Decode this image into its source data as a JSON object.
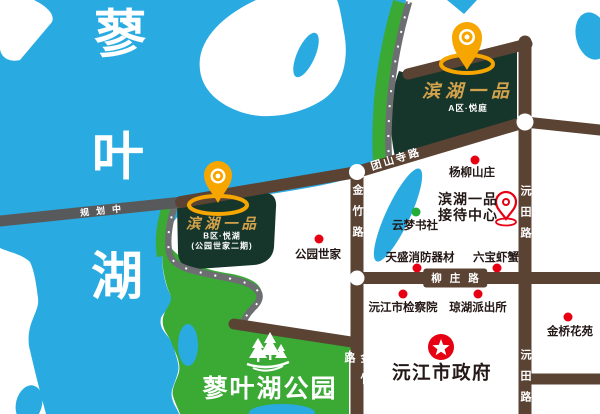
{
  "lake": {
    "char1": "蓼",
    "char2": "叶",
    "char3": "湖",
    "full_name": "蓼叶湖"
  },
  "park": {
    "name": "蓼叶湖公园"
  },
  "estate_a": {
    "title": "滨湖一品",
    "subtitle": "A区·悦庭"
  },
  "estate_b": {
    "title": "滨湖一品",
    "subtitle": "B区·悦湖",
    "note": "(公园世家二期)"
  },
  "reception": {
    "line1": "滨湖一品",
    "line2": "接待中心"
  },
  "government": {
    "name": "沅江市政府"
  },
  "roads": {
    "planned": "规划中",
    "tuanshan": "团山寺路",
    "liuzhuang": "柳庄路",
    "jinzhu": "金竹路",
    "yuantian": "沅田路"
  },
  "pois": [
    {
      "name": "杨柳山庄",
      "marker": "red-dot"
    },
    {
      "name": "云梦书社",
      "marker": "green-dot"
    },
    {
      "name": "公园世家",
      "marker": "red-dot"
    },
    {
      "name": "天盛消防器材",
      "marker": "red-dot"
    },
    {
      "name": "六宝虾蟹",
      "marker": "red-dot"
    },
    {
      "name": "沅江市检察院",
      "marker": "red-dot"
    },
    {
      "name": "琼湖派出所",
      "marker": "red-dot"
    },
    {
      "name": "金桥花苑",
      "marker": "red-dot"
    }
  ],
  "colors": {
    "lake": "#29abe2",
    "park_green": "#3aaa35",
    "estate_dark_green": "#17362b",
    "road_brown": "#5b4334",
    "road_planned_gray": "#58595b",
    "pin_gold": "#f7a600",
    "poi_red": "#e60012",
    "poi_green": "#22ac38",
    "gold_text": "#d2a24c"
  }
}
